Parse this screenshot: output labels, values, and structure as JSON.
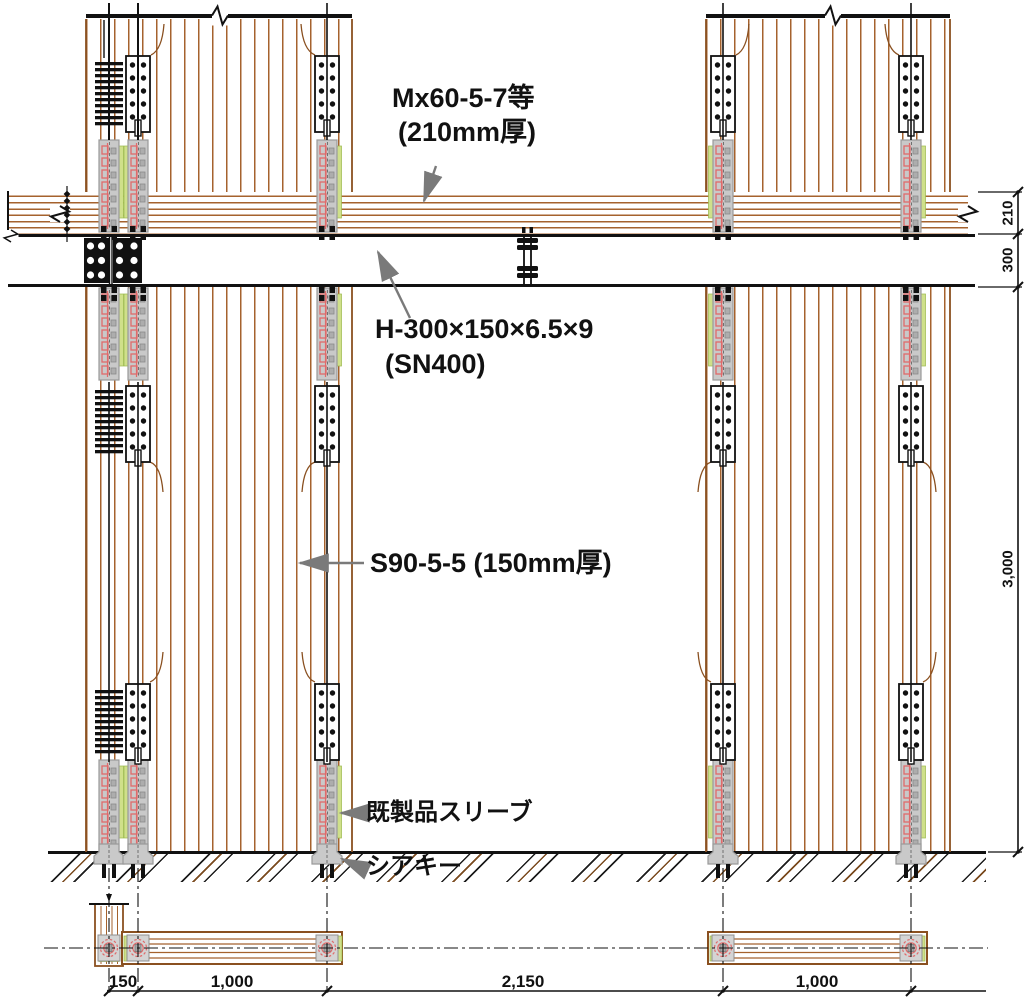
{
  "drawing": {
    "annotations": {
      "floor_panel_l1": "Mx60-5-7等",
      "floor_panel_l2": "(210mm厚)",
      "beam_l1": "H-300×150×6.5×9",
      "beam_l2": "(SN400)",
      "wall_panel": "S90-5-5 (150mm厚)",
      "sleeve": "既製品スリーブ",
      "shear_key": "シアキー"
    },
    "dimensions": {
      "bottom": [
        "150",
        "1,000",
        "2,150",
        "1,000"
      ],
      "right": [
        "210",
        "300",
        "3,000"
      ]
    },
    "colors": {
      "wood": "#a5622d",
      "wood_dark": "#8a5020",
      "ink": "#111111",
      "sleeve_gray": "#c9c9c9",
      "accent_pink": "#e06a6a",
      "edge_green": "#cfe08a",
      "leader_gray": "#7a7a7a"
    }
  }
}
